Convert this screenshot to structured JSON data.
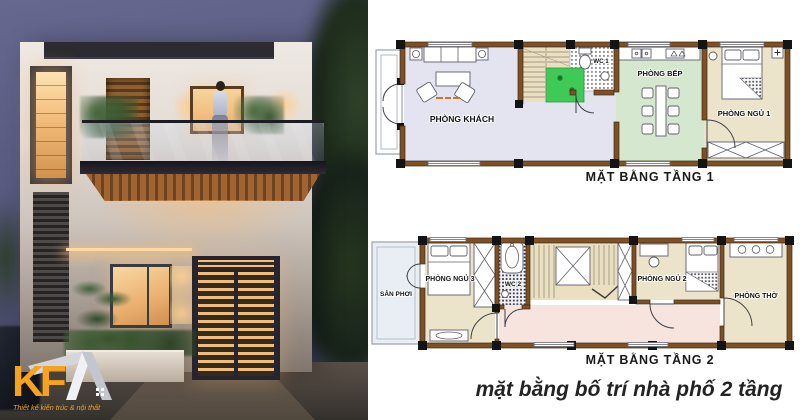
{
  "logo": {
    "kf": "KF",
    "tagline": "Thiết kế kiến trúc & nội thất"
  },
  "caption": "mặt bằng bố trí nhà phố 2 tầng",
  "floor1": {
    "title": "MẶT BẰNG TẦNG 1",
    "rooms": {
      "living": "PHÒNG KHÁCH",
      "wc": "WC 1",
      "kitchen": "PHÒNG BẾP",
      "bedroom1": "PHÒNG NGỦ 1"
    }
  },
  "floor2": {
    "title": "MẶT BẰNG TẦNG 2",
    "rooms": {
      "yard": "SÂN PHƠI",
      "bedroom3": "PHÒNG NGỦ 3",
      "wc": "WC 2",
      "bedroom2": "PHÒNG NGỦ 2",
      "worship": "PHÒNG THỜ"
    }
  },
  "colors": {
    "wall": "#7c5126",
    "column": "#141414",
    "floor_living": "#e3e4f0",
    "floor_kitchen": "#d6e7d0",
    "floor_bedroom": "#ece4ca",
    "floor_stairs": "#eadfc0",
    "landing_green": "#3fca58",
    "floor_corridor": "#f7e4df",
    "floor_yard": "#e9eef5",
    "logo_orange": "#f6a21c"
  }
}
